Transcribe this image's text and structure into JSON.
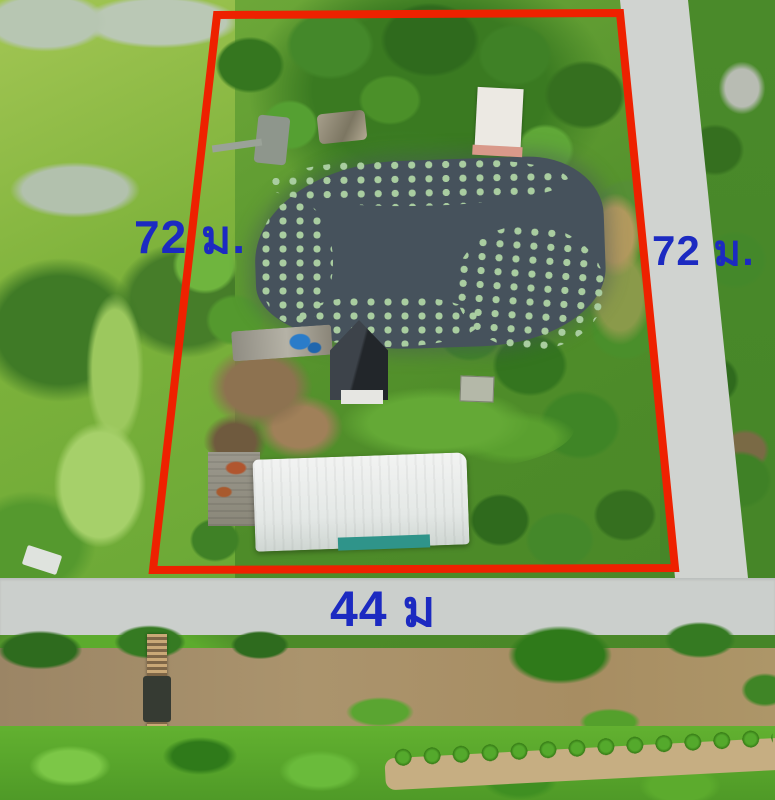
{
  "overlay": {
    "boundary_color": "#ee2100",
    "boundary_stroke_px": 8,
    "boundary_points": "217,15 620,13 675,568 153,570",
    "label_color": "#1c2ac1",
    "labels": {
      "left": "72 ม.",
      "right": "72 ม.",
      "bottom": "44 ม"
    }
  },
  "photo": {
    "road_color": "#cbcfcc",
    "pond_color": "#46525c",
    "canal_color": "#a58c63",
    "warehouse_roof_color": "#e9eceb",
    "house_roof_color": "#32373c"
  }
}
